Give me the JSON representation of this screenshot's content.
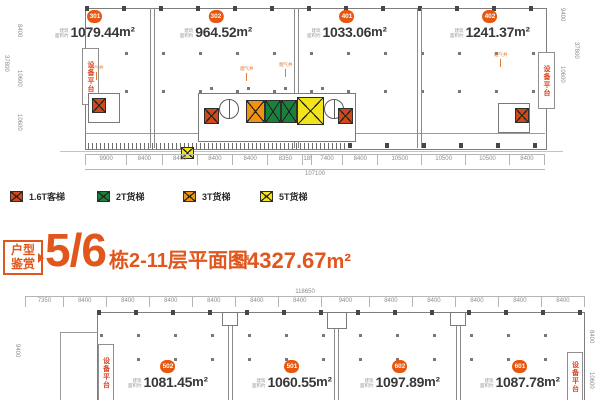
{
  "colors": {
    "accent": "#e0561c",
    "badge": "#e8560f",
    "lift_1_6t": "#cf4a1a",
    "lift_2t": "#17823c",
    "lift_3t": "#f0930f",
    "lift_5t": "#f2e41c",
    "platform_text": "#d8431f",
    "smoke_text": "#e07a35"
  },
  "labels": {
    "m2": "m²",
    "area_prefix_top": "建筑",
    "area_prefix_bottom": "面积约",
    "smoke_shaft": "烟气井",
    "equipment_platform": "设备平台"
  },
  "legend": {
    "items": [
      {
        "label": "1.6T客梯"
      },
      {
        "label": "2T货梯"
      },
      {
        "label": "3T货梯"
      },
      {
        "label": "5T货梯"
      }
    ]
  },
  "title": {
    "badge_top": "户型",
    "badge_bottom": "鉴赏",
    "number": "5/6",
    "caption": "栋2-11层平面图",
    "area_prefix_top": "建筑面",
    "area_prefix_bottom": "积约",
    "area_value": "4327.67",
    "area_unit": "m²"
  },
  "top_plan": {
    "units": [
      {
        "id": "301",
        "area": "1079.44"
      },
      {
        "id": "302",
        "area": "964.52"
      },
      {
        "id": "401",
        "area": "1033.06"
      },
      {
        "id": "402",
        "area": "1241.37"
      }
    ],
    "dims_bottom": [
      "9900",
      "8400",
      "8400",
      "8400",
      "8400",
      "8350",
      "1850",
      "7400",
      "8400",
      "10500",
      "10500",
      "10500",
      "8400"
    ],
    "dim_total": "107100",
    "dims_left": {
      "outer": "37800",
      "top": "8400",
      "mid": "10600",
      "bottom": "10600"
    },
    "dims_right": {
      "outer": "37800",
      "top": "9400",
      "mid": "10600"
    }
  },
  "bottom_plan": {
    "units": [
      {
        "id": "502",
        "area": "1081.45"
      },
      {
        "id": "501",
        "area": "1060.55"
      },
      {
        "id": "602",
        "area": "1097.89"
      },
      {
        "id": "601",
        "area": "1087.78"
      }
    ],
    "dims_top": [
      "7350",
      "8400",
      "8400",
      "8400",
      "8400",
      "8400",
      "8400",
      "9400",
      "8400",
      "8400",
      "8400",
      "8400",
      "8400"
    ],
    "dim_total": "118650",
    "dims_left": {
      "top": "9400"
    },
    "dims_right": {
      "top": "8400",
      "bottom": "10600"
    }
  }
}
